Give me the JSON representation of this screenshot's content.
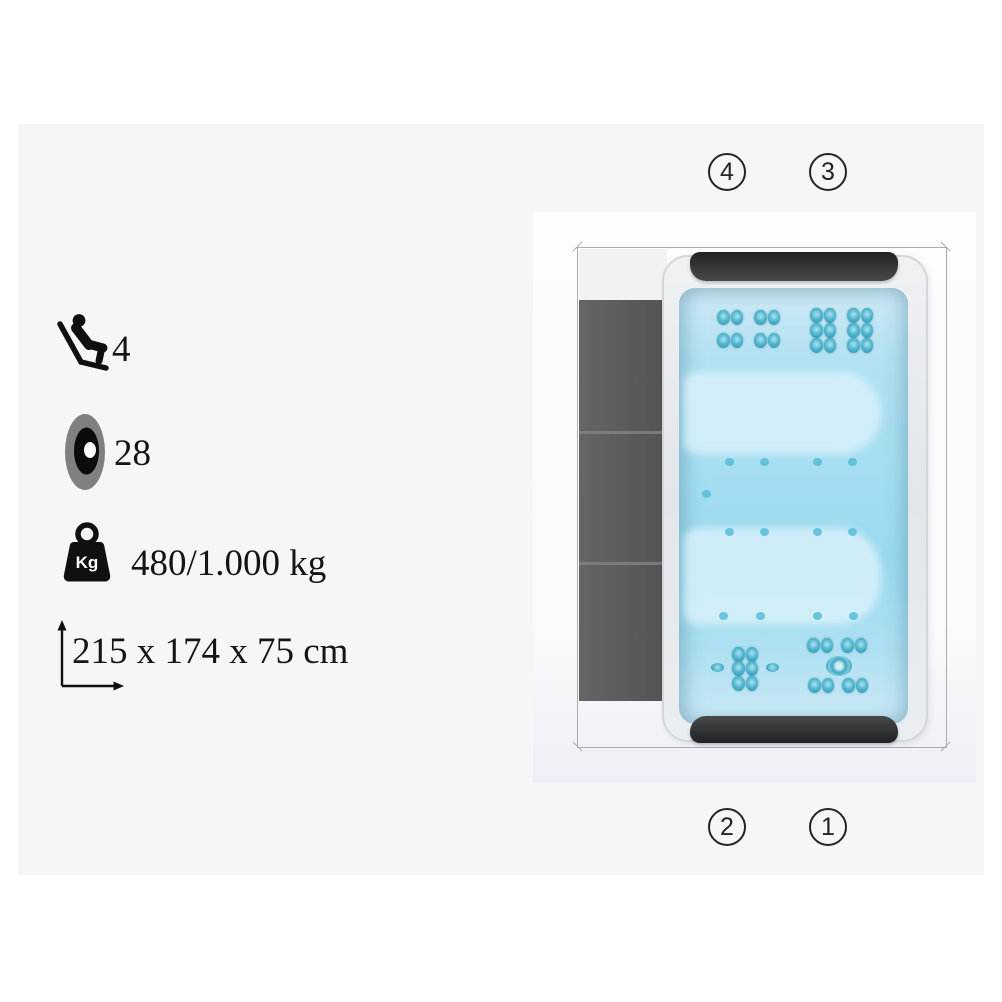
{
  "specs": {
    "seats": {
      "icon": "recliner-seat-icon",
      "value": "4"
    },
    "jets": {
      "icon": "jet-nozzle-icon",
      "value": "28"
    },
    "weight": {
      "icon": "weight-kg-icon",
      "badge": "Kg",
      "value": "480/1.000 kg"
    },
    "dimensions": {
      "icon": "dimensions-arrows-icon",
      "value": "215 x 174 x 75 cm"
    }
  },
  "diagram": {
    "type": "spa-top-view",
    "callouts": {
      "top_left": "4",
      "top_right": "3",
      "bottom_left": "2",
      "bottom_right": "1"
    }
  },
  "colors": {
    "panel_background": "#f5f6f5",
    "water": "#a7def1",
    "jet": "#3da7c2",
    "cover_panel": "#5a5b5d",
    "headrest": "#2d2d2f"
  }
}
